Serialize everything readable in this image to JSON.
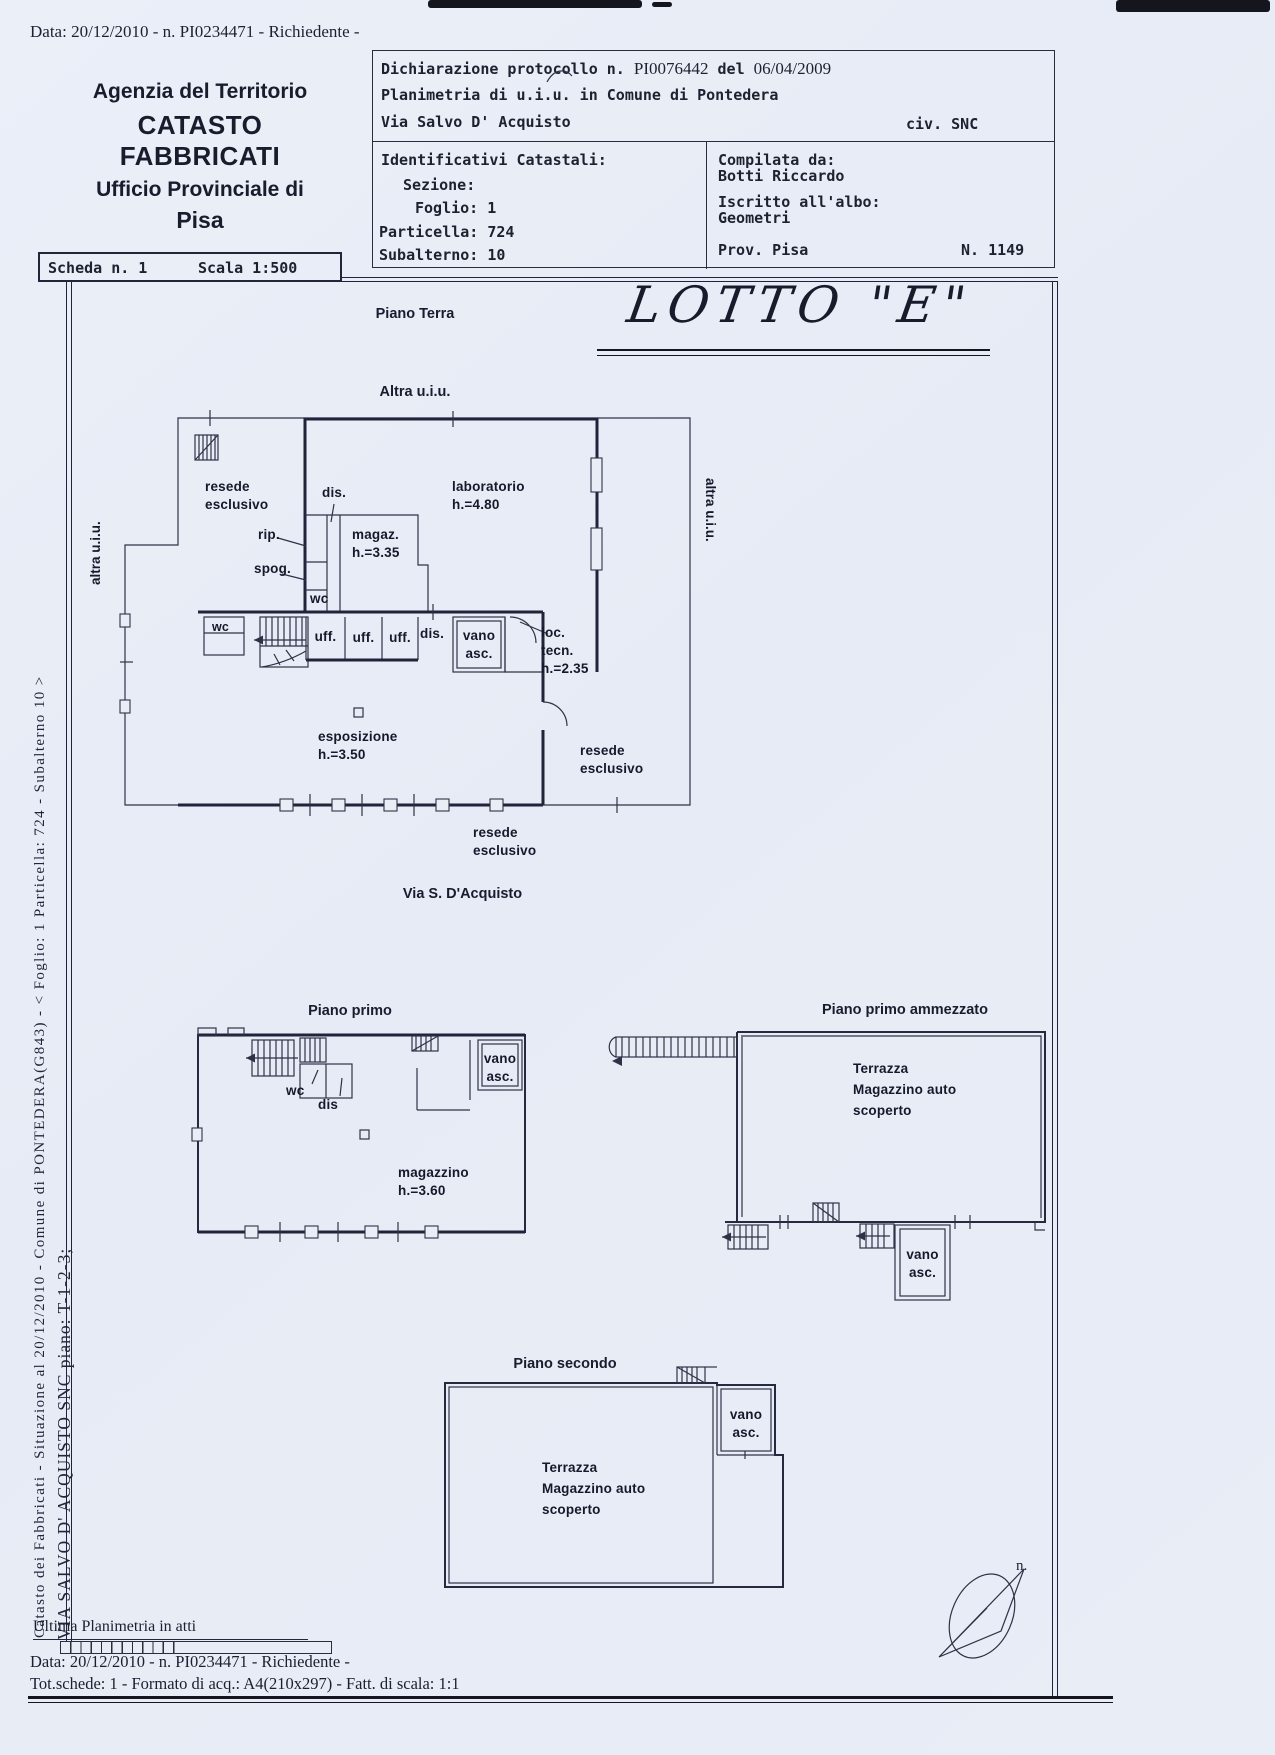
{
  "page": {
    "top_line": "Data: 20/12/2010 - n. PI0234471 - Richiedente -",
    "agency": {
      "line1": "Agenzia del Territorio",
      "line2": "CATASTO FABBRICATI",
      "line3": "Ufficio Provinciale di",
      "line4": "Pisa"
    },
    "lotto": "LOTTO \"E\"",
    "side_text_1": "Catasto dei Fabbricati - Situazione al 20/12/2010 - Comune di PONTEDERA(G843) - < Foglio: 1 Particella: 724 - Subalterno 10 >",
    "side_text_2": "VIA SALVO D' ACQUISTO SNC piano: T-1-2-3;"
  },
  "proto": {
    "dichiarazione_prefix": "Dichiarazione protocollo n.",
    "protocol_number": "PI0076442",
    "del_label": "del",
    "protocol_date": "06/04/2009",
    "planimetria_line": "Planimetria di u.i.u. in Comune di Pontedera",
    "street": "Via Salvo D' Acquisto",
    "civ": "civ. SNC",
    "identificativi_title": "Identificativi Catastali:",
    "sezione": "Sezione:",
    "foglio": "Foglio: 1",
    "particella": "Particella: 724",
    "subalterno": "Subalterno: 10",
    "compilata_da": "Compilata da:",
    "compiler": "Botti Riccardo",
    "iscritto": "Iscritto all'albo:",
    "albo": "Geometri",
    "prov": "Prov. Pisa",
    "albo_n": "N. 1149"
  },
  "scheda": {
    "scheda": "Scheda n. 1",
    "scala": "Scala 1:500"
  },
  "floors": {
    "terra": {
      "title": "Piano Terra",
      "altra_top": "Altra u.i.u.",
      "altra_left": "altra u.i.u.",
      "altra_right": "altra u.i.u.",
      "labels": {
        "resede_left": "resede\nesclusivo",
        "dis_top": "dis.",
        "laboratorio": "laboratorio\nh.=4.80",
        "rip": "rip.",
        "magaz": "magaz.\nh.=3.35",
        "spog": "spog.",
        "wc_top": "wc",
        "wc_small": "wc",
        "uff1": "uff.",
        "uff2": "uff.",
        "uff3": "uff.",
        "dis_mid": "dis.",
        "vano_asc": "vano\nasc.",
        "loc_tecn": "loc.\ntecn.\nh.=2.35",
        "esposizione": "esposizione\nh.=3.50",
        "resede_right": "resede\nesclusivo",
        "resede_bottom": "resede\nesclusivo",
        "via": "Via S. D'Acquisto"
      }
    },
    "primo": {
      "title": "Piano primo",
      "labels": {
        "vano_asc": "vano\nasc.",
        "wc": "wc",
        "dis": "dis",
        "magazzino": "magazzino\nh.=3.60"
      }
    },
    "ammezzato": {
      "title": "Piano primo ammezzato",
      "labels": {
        "terrazza_block": "Terrazza\nMagazzino auto\nscoperto",
        "vano_asc": "vano\nasc."
      }
    },
    "secondo": {
      "title": "Piano secondo",
      "labels": {
        "vano_asc": "vano\nasc.",
        "terrazza_block": "Terrazza\nMagazzino auto\nscoperto"
      }
    }
  },
  "footer": {
    "ultima": "Ultima Planimetria in atti",
    "data_line": "Data: 20/12/2010 - n. PI0234471 - Richiedente -",
    "tot_line": "Tot.schede: 1 - Formato di acq.: A4(210x297) - Fatt. di scala: 1:1",
    "north_label": "n."
  },
  "colors": {
    "paper": "#e9edf6",
    "ink": "#1d2130",
    "line": "#2e3247"
  }
}
